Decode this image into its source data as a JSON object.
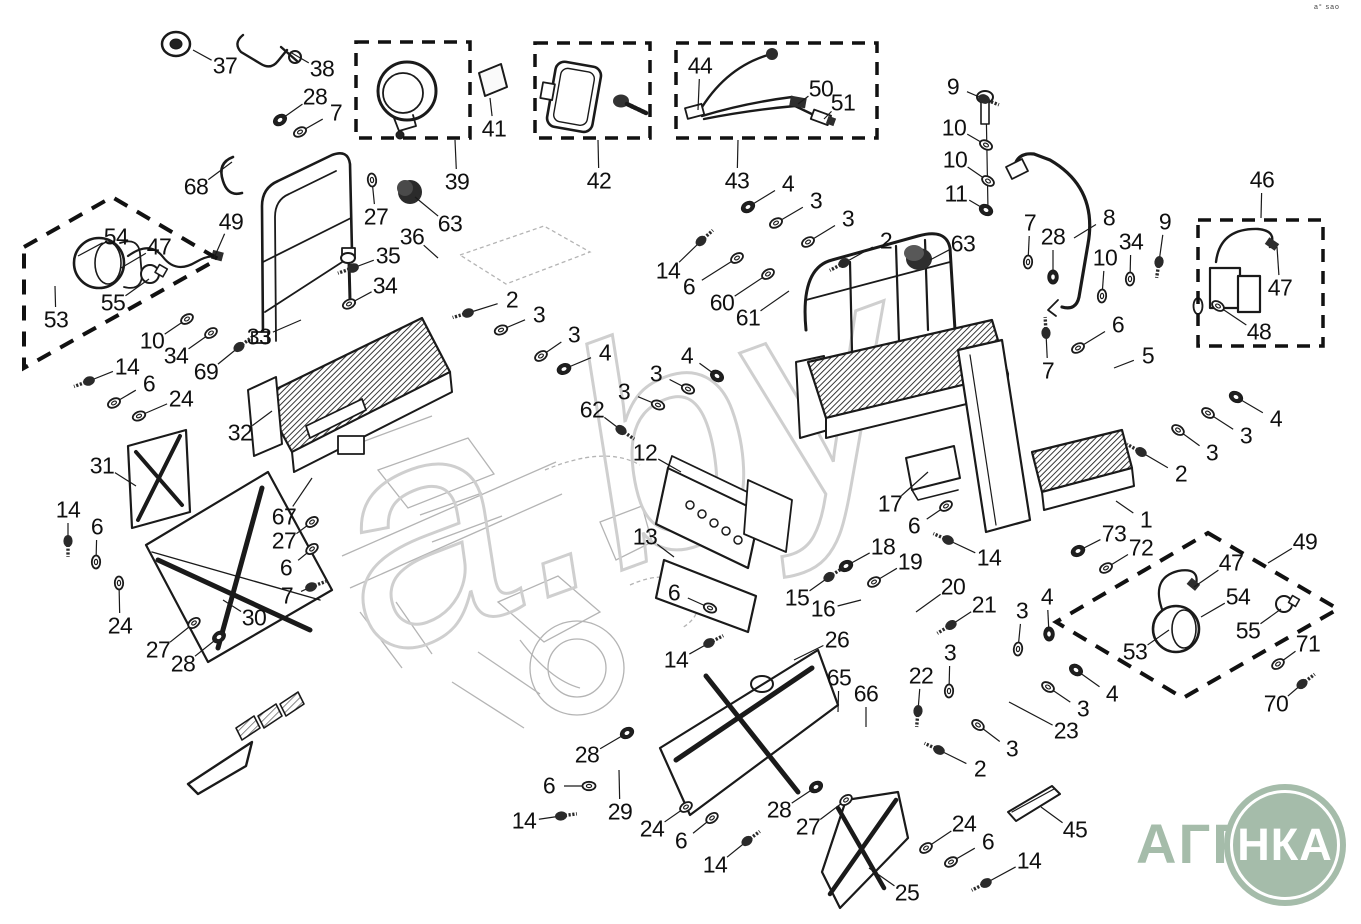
{
  "meta": {
    "background": "#ffffff",
    "line_color": "#1a1a1a",
    "dash_color": "#111111",
    "logo_green": "#a5bcaa",
    "watermark_gray": "#cfcfcf"
  },
  "corner_text": "a° sao",
  "watermark": "a.by",
  "logo": {
    "prefix": "АГРО",
    "circle_text": "НКА"
  },
  "dashed_boxes": [
    {
      "name": "box-39",
      "x": 356,
      "y": 42,
      "w": 114,
      "h": 96
    },
    {
      "name": "box-42",
      "x": 535,
      "y": 43,
      "w": 115,
      "h": 95
    },
    {
      "name": "box-43",
      "x": 676,
      "y": 43,
      "w": 201,
      "h": 95
    },
    {
      "name": "box-46",
      "x": 1198,
      "y": 220,
      "w": 125,
      "h": 126
    }
  ],
  "dashed_polygons": [
    {
      "name": "box-49-left",
      "points": "24,247 112,197 218,259 24,368"
    },
    {
      "name": "box-49-right",
      "points": "1208,533 1338,609 1183,698 1056,622"
    }
  ],
  "callouts": [
    [
      "37",
      225,
      66,
      193,
      50,
      "x"
    ],
    [
      "38",
      322,
      69,
      290,
      52,
      "x"
    ],
    [
      "28",
      315,
      97,
      280,
      120,
      "n"
    ],
    [
      "7",
      336,
      113,
      300,
      132,
      "w"
    ],
    [
      "68",
      196,
      187,
      232,
      162,
      "x"
    ],
    [
      "49",
      231,
      222,
      214,
      258,
      "x"
    ],
    [
      "27",
      376,
      217,
      372,
      180,
      "w"
    ],
    [
      "63",
      450,
      224,
      415,
      197,
      "x"
    ],
    [
      "39",
      457,
      182,
      455,
      140,
      "x"
    ],
    [
      "41",
      494,
      129,
      490,
      98,
      "x"
    ],
    [
      "42",
      599,
      181,
      598,
      140,
      "x"
    ],
    [
      "43",
      737,
      181,
      738,
      140,
      "x"
    ],
    [
      "44",
      700,
      66,
      698,
      110,
      "x"
    ],
    [
      "50",
      821,
      89,
      798,
      104,
      "x"
    ],
    [
      "51",
      843,
      103,
      824,
      119,
      "x"
    ],
    [
      "9",
      953,
      87,
      984,
      99,
      "b"
    ],
    [
      "10",
      954,
      128,
      986,
      145,
      "w"
    ],
    [
      "10",
      955,
      160,
      988,
      181,
      "w"
    ],
    [
      "11",
      956,
      194,
      986,
      210,
      "n"
    ],
    [
      "8",
      1109,
      218,
      1074,
      238,
      "x"
    ],
    [
      "7",
      1030,
      223,
      1028,
      262,
      "w"
    ],
    [
      "28",
      1053,
      237,
      1053,
      277,
      "n"
    ],
    [
      "10",
      1105,
      258,
      1102,
      296,
      "w"
    ],
    [
      "34",
      1131,
      242,
      1130,
      279,
      "w"
    ],
    [
      "9",
      1165,
      222,
      1159,
      262,
      "b"
    ],
    [
      "46",
      1262,
      180,
      1261,
      218,
      "x"
    ],
    [
      "47",
      1280,
      288,
      1277,
      247,
      "x"
    ],
    [
      "48",
      1259,
      332,
      1218,
      306,
      "w"
    ],
    [
      "63",
      963,
      244,
      930,
      260,
      "x"
    ],
    [
      "54",
      116,
      237,
      78,
      256,
      "x"
    ],
    [
      "47",
      159,
      247,
      121,
      268,
      "x"
    ],
    [
      "55",
      113,
      303,
      149,
      279,
      "x"
    ],
    [
      "53",
      56,
      320,
      55,
      286,
      "x"
    ],
    [
      "10",
      152,
      341,
      187,
      319,
      "w"
    ],
    [
      "34",
      176,
      356,
      211,
      333,
      "w"
    ],
    [
      "69",
      206,
      372,
      239,
      347,
      "b"
    ],
    [
      "33",
      259,
      337,
      301,
      320,
      "x"
    ],
    [
      "14",
      127,
      367,
      89,
      381,
      "b"
    ],
    [
      "6",
      149,
      384,
      114,
      403,
      "w"
    ],
    [
      "24",
      181,
      399,
      139,
      416,
      "w"
    ],
    [
      "35",
      388,
      256,
      353,
      268,
      "b"
    ],
    [
      "34",
      385,
      286,
      349,
      304,
      "w"
    ],
    [
      "36",
      412,
      237,
      438,
      258,
      "x"
    ],
    [
      "32",
      240,
      433,
      272,
      411,
      "x"
    ],
    [
      "2",
      512,
      300,
      468,
      313,
      "b"
    ],
    [
      "3",
      539,
      315,
      501,
      330,
      "w"
    ],
    [
      "3",
      574,
      335,
      541,
      356,
      "w"
    ],
    [
      "4",
      605,
      353,
      564,
      369,
      "n"
    ],
    [
      "4",
      788,
      184,
      748,
      207,
      "n"
    ],
    [
      "3",
      816,
      201,
      776,
      223,
      "w"
    ],
    [
      "3",
      848,
      219,
      808,
      242,
      "w"
    ],
    [
      "2",
      886,
      241,
      844,
      263,
      "b"
    ],
    [
      "14",
      668,
      271,
      701,
      241,
      "b"
    ],
    [
      "6",
      689,
      287,
      737,
      258,
      "w"
    ],
    [
      "60",
      722,
      303,
      768,
      274,
      "w"
    ],
    [
      "61",
      748,
      318,
      789,
      291,
      "x"
    ],
    [
      "4",
      687,
      356,
      717,
      376,
      "n"
    ],
    [
      "3",
      656,
      374,
      688,
      389,
      "w"
    ],
    [
      "3",
      624,
      392,
      658,
      405,
      "w"
    ],
    [
      "62",
      592,
      410,
      621,
      430,
      "b"
    ],
    [
      "12",
      645,
      453,
      681,
      472,
      "x"
    ],
    [
      "13",
      645,
      537,
      674,
      557,
      "x"
    ],
    [
      "6",
      674,
      593,
      710,
      608,
      "w"
    ],
    [
      "14",
      676,
      660,
      709,
      643,
      "b"
    ],
    [
      "17",
      890,
      504,
      928,
      472,
      "x"
    ],
    [
      "6",
      914,
      526,
      946,
      506,
      "w"
    ],
    [
      "14",
      989,
      558,
      948,
      540,
      "b"
    ],
    [
      "18",
      883,
      547,
      846,
      566,
      "n"
    ],
    [
      "19",
      910,
      562,
      874,
      582,
      "w"
    ],
    [
      "20",
      953,
      587,
      916,
      612,
      "x"
    ],
    [
      "21",
      984,
      605,
      951,
      625,
      "b"
    ],
    [
      "15",
      797,
      598,
      829,
      577,
      "b"
    ],
    [
      "16",
      823,
      609,
      861,
      600,
      "x"
    ],
    [
      "3",
      1022,
      611,
      1018,
      649,
      "w"
    ],
    [
      "4",
      1047,
      597,
      1049,
      634,
      "n"
    ],
    [
      "26",
      837,
      640,
      794,
      660,
      "x"
    ],
    [
      "65",
      839,
      678,
      838,
      712,
      "x"
    ],
    [
      "66",
      866,
      694,
      866,
      727,
      "x"
    ],
    [
      "22",
      921,
      676,
      918,
      711,
      "b"
    ],
    [
      "3",
      950,
      653,
      949,
      691,
      "w"
    ],
    [
      "23",
      1066,
      731,
      1009,
      702,
      "x"
    ],
    [
      "3",
      1083,
      709,
      1048,
      687,
      "w"
    ],
    [
      "4",
      1112,
      694,
      1076,
      670,
      "n"
    ],
    [
      "3",
      1012,
      749,
      978,
      725,
      "w"
    ],
    [
      "2",
      980,
      769,
      939,
      750,
      "b"
    ],
    [
      "31",
      102,
      466,
      136,
      486,
      "x"
    ],
    [
      "14",
      68,
      510,
      68,
      541,
      "b"
    ],
    [
      "6",
      97,
      527,
      96,
      562,
      "w"
    ],
    [
      "24",
      120,
      626,
      119,
      583,
      "w"
    ],
    [
      "27",
      158,
      650,
      194,
      623,
      "w"
    ],
    [
      "28",
      183,
      664,
      219,
      637,
      "n"
    ],
    [
      "30",
      254,
      618,
      223,
      600,
      "x"
    ],
    [
      "67",
      284,
      517,
      312,
      478,
      "x"
    ],
    [
      "27",
      284,
      541,
      312,
      522,
      "w"
    ],
    [
      "6",
      286,
      568,
      312,
      549,
      "w"
    ],
    [
      "7",
      287,
      596,
      311,
      587,
      "b"
    ],
    [
      "5",
      1148,
      356,
      1114,
      368,
      "x"
    ],
    [
      "6",
      1118,
      325,
      1078,
      348,
      "w"
    ],
    [
      "7",
      1048,
      371,
      1046,
      333,
      "b"
    ],
    [
      "1",
      1146,
      520,
      1116,
      501,
      "x"
    ],
    [
      "73",
      1114,
      534,
      1078,
      551,
      "n"
    ],
    [
      "72",
      1141,
      548,
      1106,
      568,
      "w"
    ],
    [
      "4",
      1276,
      419,
      1236,
      397,
      "n"
    ],
    [
      "3",
      1246,
      436,
      1208,
      413,
      "w"
    ],
    [
      "3",
      1212,
      453,
      1178,
      430,
      "w"
    ],
    [
      "2",
      1181,
      474,
      1141,
      452,
      "b"
    ],
    [
      "49",
      1305,
      542,
      1268,
      563,
      "x"
    ],
    [
      "47",
      1231,
      563,
      1194,
      587,
      "x"
    ],
    [
      "54",
      1238,
      597,
      1201,
      617,
      "x"
    ],
    [
      "55",
      1248,
      631,
      1281,
      609,
      "x"
    ],
    [
      "53",
      1135,
      652,
      1169,
      630,
      "x"
    ],
    [
      "71",
      1308,
      644,
      1278,
      664,
      "w"
    ],
    [
      "70",
      1276,
      704,
      1302,
      684,
      "b"
    ],
    [
      "28",
      587,
      755,
      627,
      733,
      "n"
    ],
    [
      "6",
      549,
      786,
      589,
      786,
      "w"
    ],
    [
      "29",
      620,
      812,
      619,
      770,
      "x"
    ],
    [
      "24",
      652,
      829,
      686,
      807,
      "w"
    ],
    [
      "6",
      681,
      841,
      712,
      818,
      "w"
    ],
    [
      "14",
      715,
      865,
      747,
      841,
      "b"
    ],
    [
      "14",
      524,
      821,
      561,
      816,
      "b"
    ],
    [
      "28",
      779,
      810,
      816,
      787,
      "n"
    ],
    [
      "27",
      808,
      827,
      846,
      800,
      "w"
    ],
    [
      "25",
      907,
      893,
      869,
      868,
      "x"
    ],
    [
      "24",
      964,
      824,
      926,
      848,
      "w"
    ],
    [
      "6",
      988,
      842,
      951,
      862,
      "w"
    ],
    [
      "14",
      1029,
      861,
      986,
      883,
      "b"
    ],
    [
      "45",
      1075,
      830,
      1041,
      807,
      "x"
    ]
  ]
}
